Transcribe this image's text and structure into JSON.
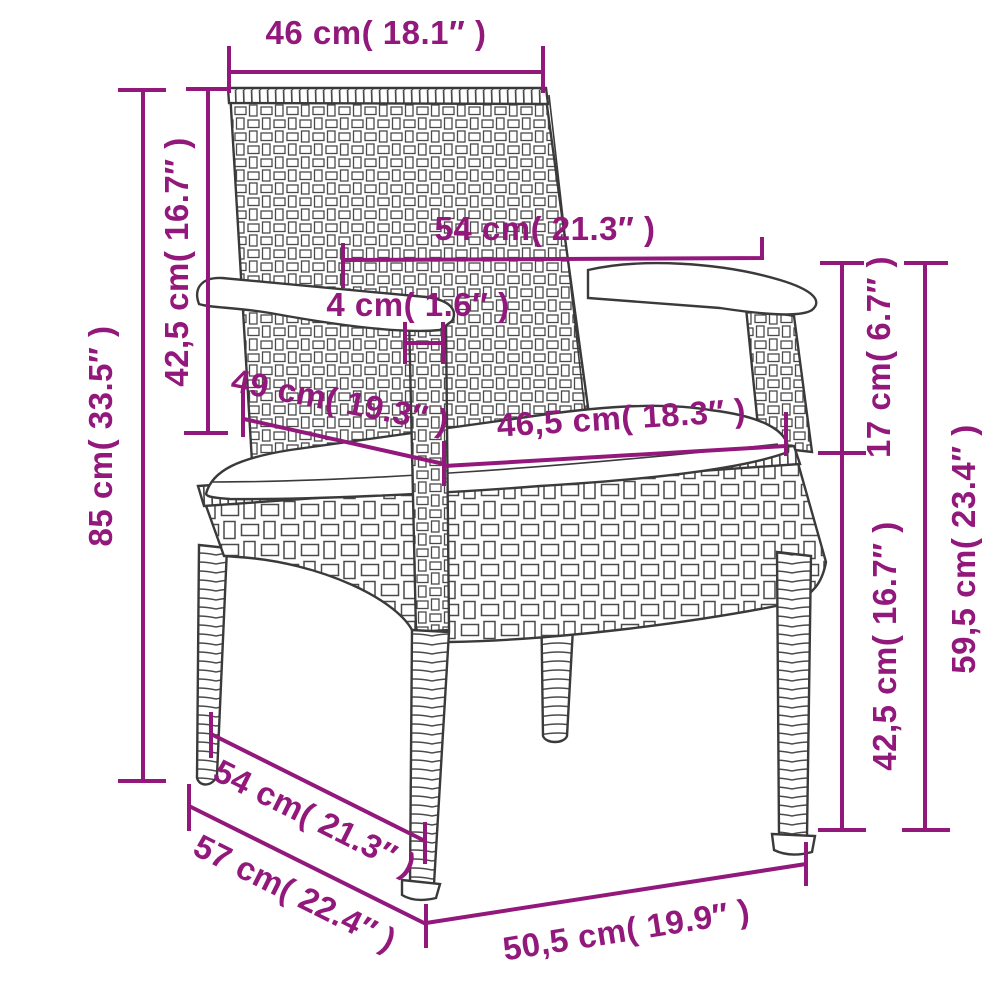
{
  "diagram": {
    "type": "product-dimension-diagram",
    "subject": "poly rattan garden chair with seat cushion",
    "accent_color": "#92187c",
    "line_art_color": "#3a3a3a",
    "background_color": "#ffffff"
  },
  "labels": {
    "back_width_top": "46 cm( 18.1″ )",
    "backrest_height": "42,5 cm( 16.7″ )",
    "total_height": "85 cm( 33.5″ )",
    "width_at_armrests": "54 cm( 21.3″ )",
    "armrest_strut_thickness": "4 cm( 1.6″ )",
    "seat_depth": "49 cm( 19.3″ )",
    "seat_width": "46,5 cm( 18.3″ )",
    "backrest_above_armrest": "17 cm( 6.7″ )",
    "armrest_height_lower": "42,5 cm( 16.7″ )",
    "armrest_height_total": "59,5 cm( 23.4″ )",
    "depth_between_feet": "54 cm( 21.3″ )",
    "total_depth": "57 cm( 22.4″ )",
    "front_width_bottom": "50,5 cm( 19.9″ )"
  }
}
